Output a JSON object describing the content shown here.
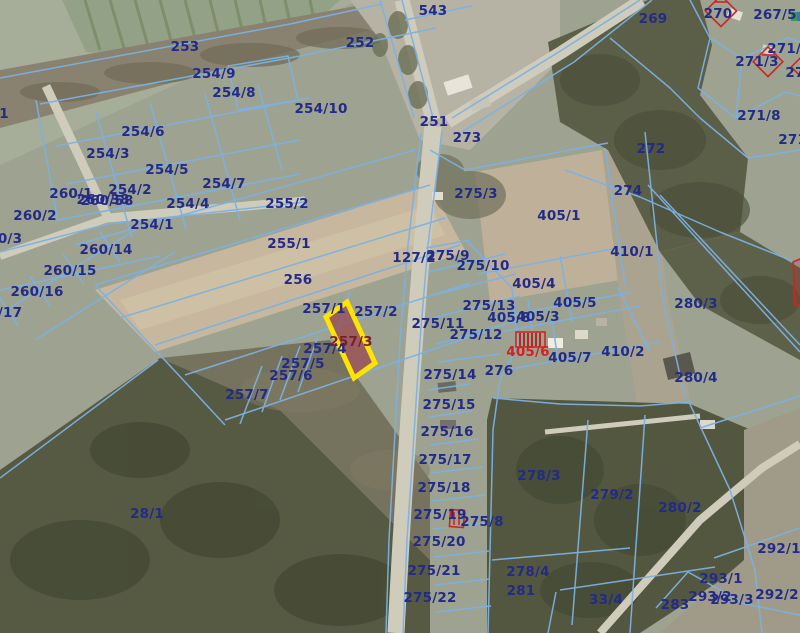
{
  "map": {
    "title": "cadastral-parcel-map",
    "highlight": {
      "parcel_id": "257/3",
      "stroke_color": "#ffe400",
      "fill_color": "rgba(152,38,52,0.55)",
      "label_color": "#7c1f2d"
    },
    "colors": {
      "boundary_line": "#7cb1e3",
      "parcel_label": "#232a87",
      "red_label": "#d42020",
      "red_symbol": "#cf2525"
    },
    "labels": [
      {
        "t": "543",
        "x": 433,
        "y": 15
      },
      {
        "t": "253",
        "x": 185,
        "y": 51
      },
      {
        "t": "252",
        "x": 360,
        "y": 47
      },
      {
        "t": "269",
        "x": 653,
        "y": 23
      },
      {
        "t": "270",
        "x": 718,
        "y": 18
      },
      {
        "t": "267/5",
        "x": 775,
        "y": 19
      },
      {
        "t": "254/9",
        "x": 214,
        "y": 78
      },
      {
        "t": "254/8",
        "x": 234,
        "y": 97
      },
      {
        "t": "254/10",
        "x": 321,
        "y": 113
      },
      {
        "t": "251",
        "x": 434,
        "y": 126
      },
      {
        "t": "273",
        "x": 467,
        "y": 142
      },
      {
        "t": "271/4",
        "x": 789,
        "y": 53
      },
      {
        "t": "271/3",
        "x": 757,
        "y": 66
      },
      {
        "t": "27",
        "x": 795,
        "y": 77
      },
      {
        "t": "271/8",
        "x": 759,
        "y": 120
      },
      {
        "t": "271/7",
        "x": 800,
        "y": 144
      },
      {
        "t": "272",
        "x": 651,
        "y": 153
      },
      {
        "t": "274",
        "x": 628,
        "y": 195
      },
      {
        "t": "254/6",
        "x": 143,
        "y": 136
      },
      {
        "t": "254/3",
        "x": 108,
        "y": 158
      },
      {
        "t": "254/5",
        "x": 167,
        "y": 174
      },
      {
        "t": "254/7",
        "x": 224,
        "y": 188
      },
      {
        "t": "254/2",
        "x": 130,
        "y": 194
      },
      {
        "t": "260/1",
        "x": 71,
        "y": 198
      },
      {
        "t": "254/4",
        "x": 188,
        "y": 208
      },
      {
        "t": "260/2",
        "x": 35,
        "y": 220
      },
      {
        "t": "260/38",
        "x": 103,
        "y": 204
      },
      {
        "t": "260/58",
        "x": 107,
        "y": 205
      },
      {
        "t": "254/1",
        "x": 152,
        "y": 229
      },
      {
        "t": "1",
        "x": 4,
        "y": 118
      },
      {
        "t": "0/3",
        "x": 10,
        "y": 243
      },
      {
        "t": "/17",
        "x": 10,
        "y": 317
      },
      {
        "t": "255/2",
        "x": 287,
        "y": 208
      },
      {
        "t": "260/14",
        "x": 106,
        "y": 254
      },
      {
        "t": "260/15",
        "x": 70,
        "y": 275
      },
      {
        "t": "260/16",
        "x": 37,
        "y": 296
      },
      {
        "t": "255/1",
        "x": 289,
        "y": 248
      },
      {
        "t": "256",
        "x": 298,
        "y": 284
      },
      {
        "t": "127/2",
        "x": 414,
        "y": 262
      },
      {
        "t": "275/9",
        "x": 448,
        "y": 260
      },
      {
        "t": "275/10",
        "x": 483,
        "y": 270
      },
      {
        "t": "275/3",
        "x": 476,
        "y": 198
      },
      {
        "t": "405/1",
        "x": 559,
        "y": 220
      },
      {
        "t": "410/1",
        "x": 632,
        "y": 256
      },
      {
        "t": "280/3",
        "x": 696,
        "y": 308
      },
      {
        "t": "257/1",
        "x": 324,
        "y": 313
      },
      {
        "t": "257/2",
        "x": 376,
        "y": 316
      },
      {
        "t": "275/11",
        "x": 438,
        "y": 328
      },
      {
        "t": "275/13",
        "x": 489,
        "y": 310
      },
      {
        "t": "405/8",
        "x": 509,
        "y": 322
      },
      {
        "t": "405/3",
        "x": 538,
        "y": 321
      },
      {
        "t": "405/4",
        "x": 534,
        "y": 288
      },
      {
        "t": "405/5",
        "x": 575,
        "y": 307
      },
      {
        "t": "257/3",
        "x": 351,
        "y": 346,
        "c": "maroon"
      },
      {
        "t": "257/4",
        "x": 325,
        "y": 353
      },
      {
        "t": "257/5",
        "x": 303,
        "y": 368
      },
      {
        "t": "257/6",
        "x": 291,
        "y": 380
      },
      {
        "t": "257/7",
        "x": 247,
        "y": 399
      },
      {
        "t": "275/12",
        "x": 476,
        "y": 339
      },
      {
        "t": "405/6",
        "x": 528,
        "y": 356,
        "c": "red"
      },
      {
        "t": "405/7",
        "x": 570,
        "y": 362
      },
      {
        "t": "410/2",
        "x": 623,
        "y": 356
      },
      {
        "t": "276",
        "x": 499,
        "y": 375
      },
      {
        "t": "280/4",
        "x": 696,
        "y": 382
      },
      {
        "t": "275/14",
        "x": 450,
        "y": 379
      },
      {
        "t": "275/15",
        "x": 449,
        "y": 409
      },
      {
        "t": "275/16",
        "x": 447,
        "y": 436
      },
      {
        "t": "275/17",
        "x": 445,
        "y": 464
      },
      {
        "t": "275/18",
        "x": 444,
        "y": 492
      },
      {
        "t": "275/19",
        "x": 440,
        "y": 519
      },
      {
        "t": "275/8",
        "x": 482,
        "y": 526
      },
      {
        "t": "275/20",
        "x": 439,
        "y": 546
      },
      {
        "t": "275/21",
        "x": 434,
        "y": 575
      },
      {
        "t": "275/22",
        "x": 430,
        "y": 602
      },
      {
        "t": "278/3",
        "x": 539,
        "y": 480
      },
      {
        "t": "279/2",
        "x": 612,
        "y": 499
      },
      {
        "t": "280/2",
        "x": 680,
        "y": 512
      },
      {
        "t": "278/4",
        "x": 528,
        "y": 576
      },
      {
        "t": "281",
        "x": 521,
        "y": 595
      },
      {
        "t": "283",
        "x": 675,
        "y": 609
      },
      {
        "t": "33/4",
        "x": 606,
        "y": 604
      },
      {
        "t": "28/1",
        "x": 147,
        "y": 518
      },
      {
        "t": "292/1",
        "x": 779,
        "y": 553
      },
      {
        "t": "293/1",
        "x": 721,
        "y": 583
      },
      {
        "t": "293/2",
        "x": 710,
        "y": 601
      },
      {
        "t": "293/3",
        "x": 732,
        "y": 604
      },
      {
        "t": "292/2",
        "x": 777,
        "y": 599
      }
    ]
  }
}
